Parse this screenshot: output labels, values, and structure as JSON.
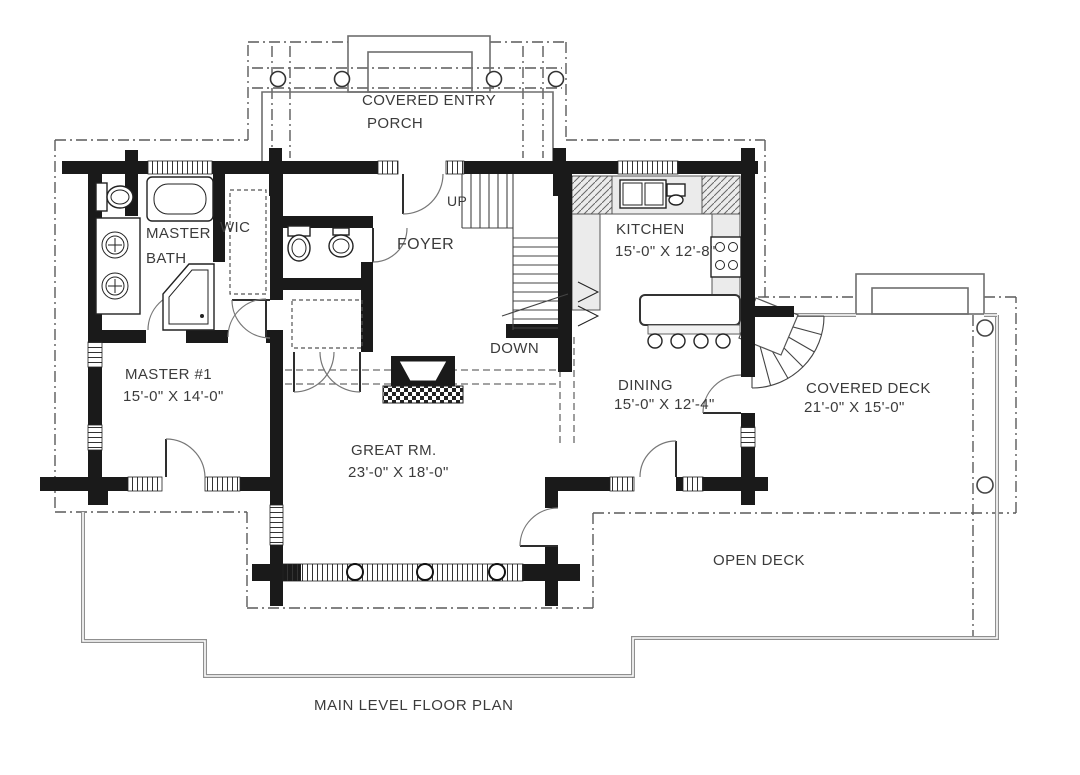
{
  "plan": {
    "sheet_title": "MAIN LEVEL FLOOR PLAN",
    "rooms": {
      "covered_entry_porch": {
        "name_line1": "COVERED ENTRY",
        "name_line2": "PORCH"
      },
      "master_bath": {
        "name_line1": "MASTER",
        "name_line2": "BATH"
      },
      "wic": {
        "name": "WIC"
      },
      "foyer": {
        "name": "FOYER"
      },
      "kitchen": {
        "name": "KITCHEN",
        "dims": "15'-0\" X 12'-8\""
      },
      "master_1": {
        "name": "MASTER #1",
        "dims": "15'-0\" X 14'-0\""
      },
      "dining": {
        "name": "DINING",
        "dims": "15'-0\" X 12'-4\""
      },
      "great_room": {
        "name": "GREAT RM.",
        "dims": "23'-0\" X 18'-0\""
      },
      "covered_deck": {
        "name": "COVERED DECK",
        "dims": "21'-0\" X 15'-0\""
      },
      "open_deck": {
        "name": "OPEN DECK"
      }
    },
    "stairs": {
      "up_label": "UP",
      "down_label": "DOWN"
    },
    "colors": {
      "wall_ink": "#1a1a1a",
      "line_gray": "#8f8f8f",
      "text": "#3b3b3b",
      "counter_fill": "#ebebeb"
    }
  }
}
